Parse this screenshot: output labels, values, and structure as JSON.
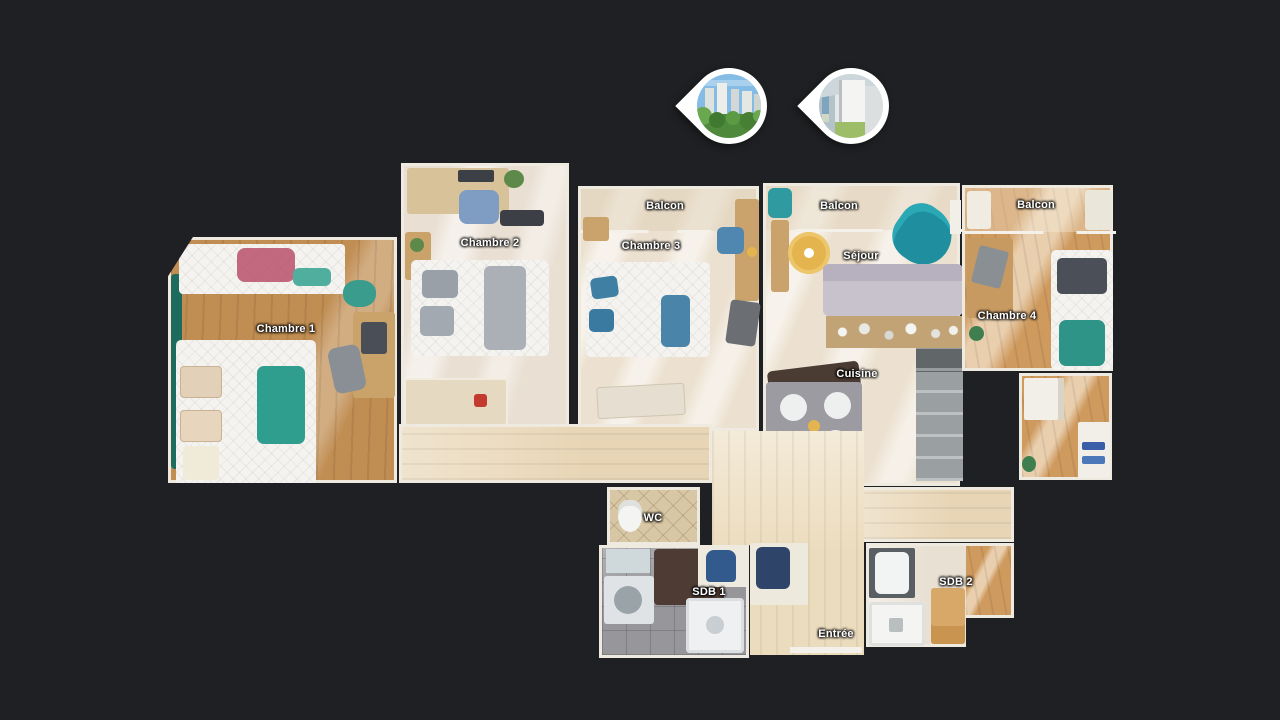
{
  "app": {
    "view_name": "dollhouse-floorplan-view",
    "background_color": "#1f2023",
    "label_color": "#ffffff"
  },
  "pins": [
    {
      "name": "exterior-view-pin",
      "icon": "map-pin",
      "thumbnail": "city-buildings-and-trees-view"
    },
    {
      "name": "balcony-view-pin",
      "icon": "map-pin",
      "thumbnail": "balcony-interior-view"
    }
  ],
  "floorplan": {
    "rooms": [
      {
        "id": "chambre-1",
        "label": "Chambre 1"
      },
      {
        "id": "chambre-2",
        "label": "Chambre 2"
      },
      {
        "id": "balcon-chambre-3",
        "label": "Balcon"
      },
      {
        "id": "chambre-3",
        "label": "Chambre 3"
      },
      {
        "id": "balcon-sejour",
        "label": "Balcon"
      },
      {
        "id": "sejour",
        "label": "Séjour"
      },
      {
        "id": "cuisine",
        "label": "Cuisine"
      },
      {
        "id": "balcon-chambre-4",
        "label": "Balcon"
      },
      {
        "id": "chambre-4",
        "label": "Chambre 4"
      },
      {
        "id": "wc",
        "label": "WC"
      },
      {
        "id": "sdb-1",
        "label": "SDB 1"
      },
      {
        "id": "entree",
        "label": "Entrée"
      },
      {
        "id": "sdb-2",
        "label": "SDB 2"
      }
    ],
    "palette": {
      "wood_oak": "#c08d52",
      "wood_orange": "#cf9a5e",
      "floor_cream": "#e9dfd2",
      "floor_hall": "#e8d5b5",
      "tile_gray": "#97979b",
      "tile_beige": "#d8c7a5",
      "accent_teal": "#2e9488",
      "accent_blue": "#4a84a8",
      "sofa_gray": "#c7c2cc",
      "wall_white": "#efeae0"
    }
  }
}
